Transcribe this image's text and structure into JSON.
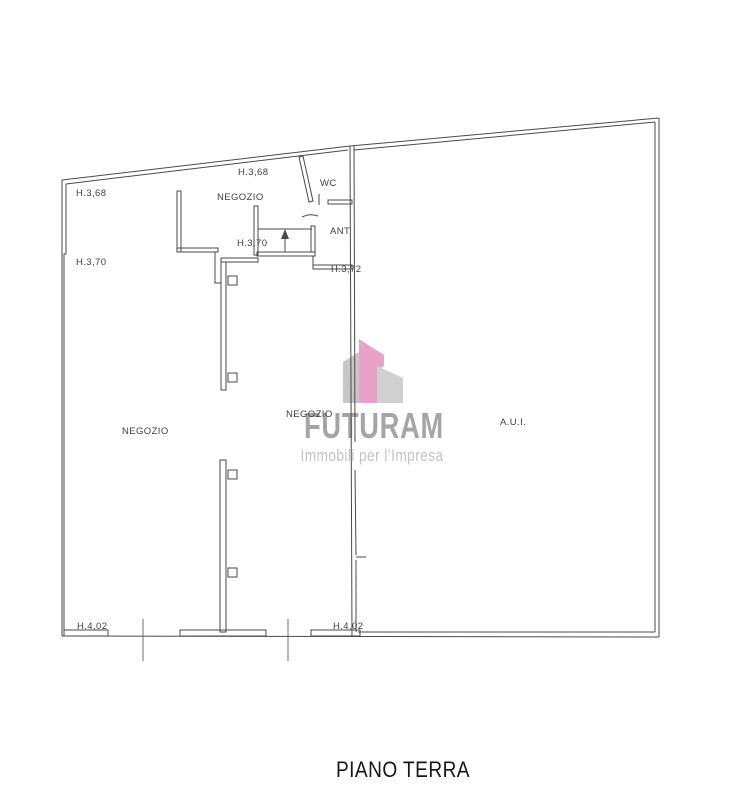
{
  "plan": {
    "title": "PIANO TERRA",
    "rooms": [
      {
        "id": "negozio-top",
        "label": "NEGOZIO"
      },
      {
        "id": "wc",
        "label": "WC"
      },
      {
        "id": "ant",
        "label": "ANT"
      },
      {
        "id": "negozio-left",
        "label": "NEGOZIO"
      },
      {
        "id": "negozio-middle",
        "label": "NEGOZIO"
      },
      {
        "id": "aui",
        "label": "A.U.I."
      }
    ],
    "heights": [
      {
        "id": "top-left",
        "label": "H.3,68"
      },
      {
        "id": "top-middle",
        "label": "H.3,68"
      },
      {
        "id": "mid-left",
        "label": "H.3,70"
      },
      {
        "id": "mid-middle",
        "label": "H.3,70"
      },
      {
        "id": "mid-right",
        "label": "H.3,72"
      },
      {
        "id": "bottom-left",
        "label": "H.4,02"
      },
      {
        "id": "bottom-middle",
        "label": "H.4,02"
      }
    ]
  },
  "logo": {
    "name": "FUTURAM",
    "tagline": "Immobili per l’Impresa",
    "colors": {
      "pink": "#e8a2c8",
      "gray_left": "#c7c7c7",
      "gray_right": "#d0d0d0",
      "wordmark": "#a5a5a5",
      "tagline": "#c3c3c3"
    }
  },
  "colors": {
    "line": "#4a4a4a",
    "background": "#ffffff"
  }
}
